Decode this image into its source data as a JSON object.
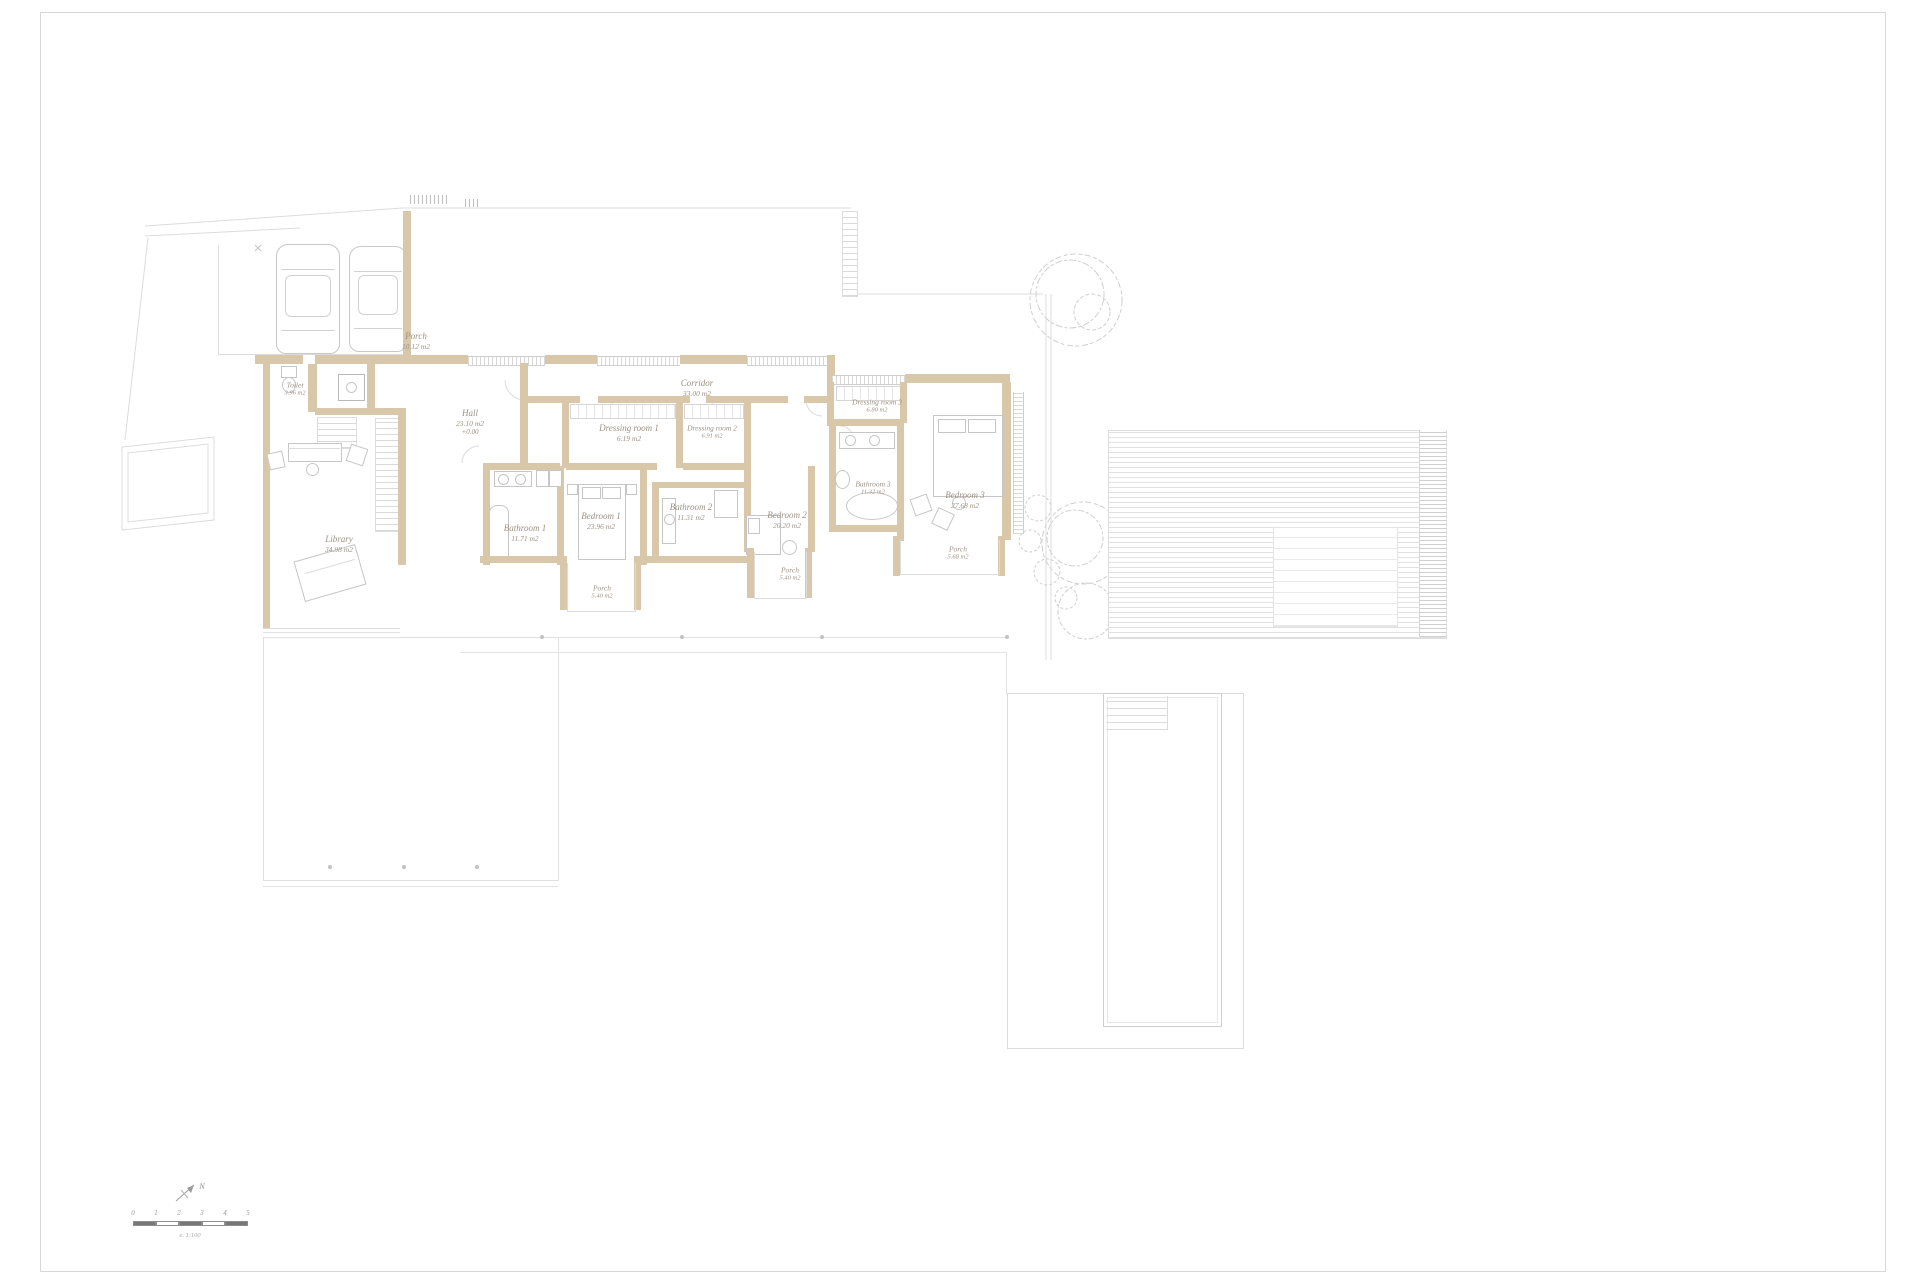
{
  "rooms": {
    "porch_garage": {
      "name": "Porch",
      "area": "10.12 m2"
    },
    "toilet": {
      "name": "Toilet",
      "area": "3.96 m2"
    },
    "hall": {
      "name": "Hall",
      "area": "23.10 m2",
      "level": "+0.00"
    },
    "corridor": {
      "name": "Corridor",
      "area": "33.00 m2"
    },
    "dressing1": {
      "name": "Dressing room 1",
      "area": "6.19 m2"
    },
    "dressing2": {
      "name": "Dressing room 2",
      "area": "6.91 m2"
    },
    "dressing3": {
      "name": "Dressing room 3",
      "area": "6.80 m2"
    },
    "bathroom1": {
      "name": "Bathroom 1",
      "area": "11.71 m2"
    },
    "bathroom2": {
      "name": "Bathroom 2",
      "area": "11.31 m2"
    },
    "bathroom3": {
      "name": "Bathroom 3",
      "area": "11.32 m2"
    },
    "bedroom1": {
      "name": "Bedroom 1",
      "area": "23.96 m2"
    },
    "bedroom2": {
      "name": "Bedroom 2",
      "area": "20.20 m2"
    },
    "bedroom3": {
      "name": "Bedroom 3",
      "area": "27.68 m2"
    },
    "library": {
      "name": "Library",
      "area": "34.98 m2"
    },
    "porch1": {
      "name": "Porch",
      "area": "5.40 m2"
    },
    "porch2": {
      "name": "Porch",
      "area": "5.40 m2"
    },
    "porch3": {
      "name": "Porch",
      "area": "5.68 m2"
    }
  },
  "north": {
    "label": "N"
  },
  "scalebar": {
    "ticks": [
      "0",
      "1",
      "2",
      "3",
      "4",
      "5"
    ],
    "scale_text": "e. 1:100"
  },
  "colors": {
    "wall": "#d9c7a9",
    "site_line": "#dcdcdc",
    "furniture": "#c6c6c6",
    "label_text": "#9c9285",
    "scalebar_dark": "#777777"
  }
}
